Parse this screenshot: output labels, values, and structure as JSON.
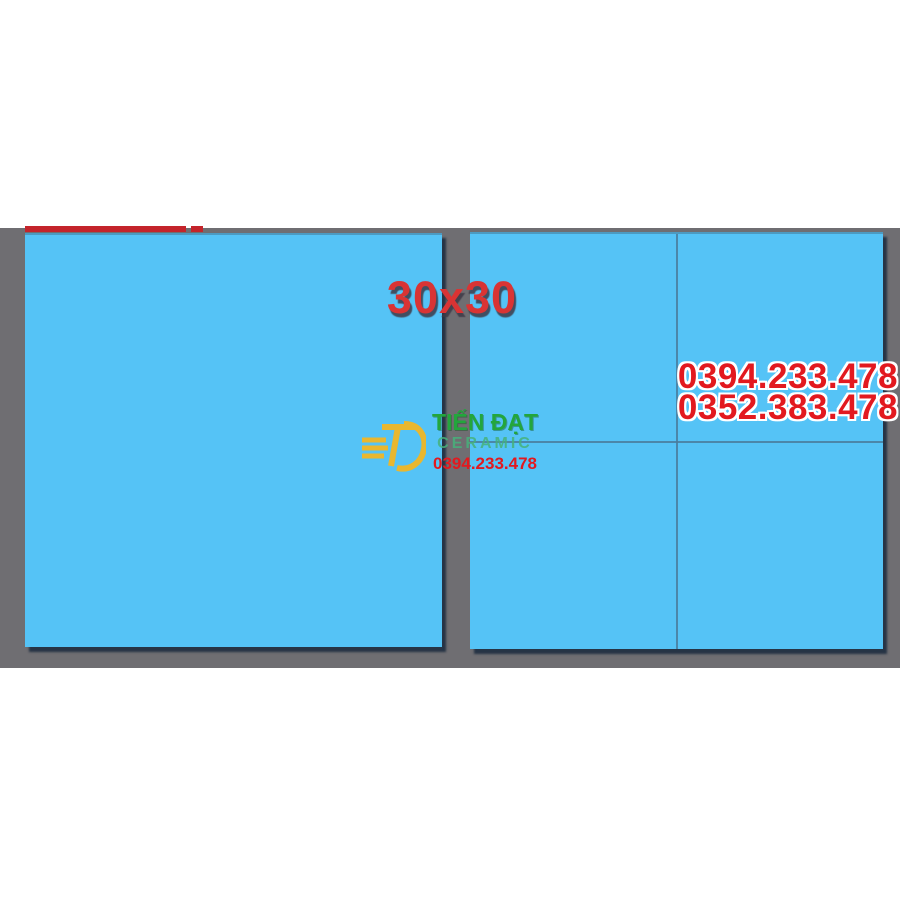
{
  "colors": {
    "tile_blue": "#55c3f6",
    "backdrop_gray": "#6f6e72",
    "grout_line": "#4a7d9c",
    "tile_shadow": "#1c3349",
    "accent_red": "#e2191f",
    "size_red": "#d93434",
    "banner_red": "#c4242b",
    "logo_yellow": "#e9b72f",
    "logo_green": "#23a63c",
    "logo_teal": "#46b27b"
  },
  "overlays": {
    "size_label": "30x30",
    "contact_phones": [
      "0394.233.478",
      "0352.383.478"
    ],
    "logo": {
      "monogram": "TD",
      "brand": "TIẾN ĐẠT",
      "subtitle": "CERAMIC",
      "phone": "0394.233.478"
    }
  }
}
